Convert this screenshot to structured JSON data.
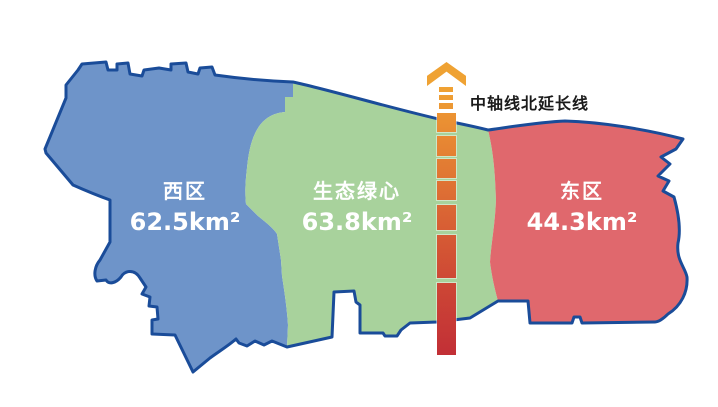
{
  "regions": [
    {
      "id": "west",
      "name": "西区",
      "area": "62.5km²",
      "color": "#6E94C9"
    },
    {
      "id": "green",
      "name": "生态绿心",
      "area": "63.8km²",
      "color": "#A8D29C"
    },
    {
      "id": "east",
      "name": "东区",
      "area": "44.3km²",
      "color": "#E0686D"
    }
  ],
  "colors": {
    "outline": "#1A4C99",
    "background": "#FFFFFF",
    "label_text": "#FFFFFF",
    "axis_label_text": "#1A1A1A"
  },
  "axis": {
    "label": "中轴线北延长线",
    "arrow_color": "#EFA233",
    "center_x": 446,
    "segments": [
      {
        "top": 87,
        "h": 5,
        "w": 14,
        "c1": "#F0A233",
        "c2": "#EFA033"
      },
      {
        "top": 95,
        "h": 5,
        "w": 14,
        "c1": "#EF9E33",
        "c2": "#EE9C33"
      },
      {
        "top": 103,
        "h": 6,
        "w": 14,
        "c1": "#ED9933",
        "c2": "#EC9733"
      },
      {
        "top": 113,
        "h": 19,
        "w": 19,
        "c1": "#EC9433",
        "c2": "#E88B33"
      },
      {
        "top": 136,
        "h": 20,
        "w": 19,
        "c1": "#E88933",
        "c2": "#E48033"
      },
      {
        "top": 159,
        "h": 19,
        "w": 19,
        "c1": "#E37E33",
        "c2": "#E07633"
      },
      {
        "top": 181,
        "h": 19,
        "w": 19,
        "c1": "#E07333",
        "c2": "#DC6B34"
      },
      {
        "top": 205,
        "h": 25,
        "w": 19,
        "c1": "#DB6834",
        "c2": "#D75D34"
      },
      {
        "top": 235,
        "h": 43,
        "w": 19,
        "c1": "#D65B34",
        "c2": "#CE4935"
      },
      {
        "top": 283,
        "h": 72,
        "w": 19,
        "c1": "#CD4735",
        "c2": "#C22F36"
      }
    ]
  }
}
